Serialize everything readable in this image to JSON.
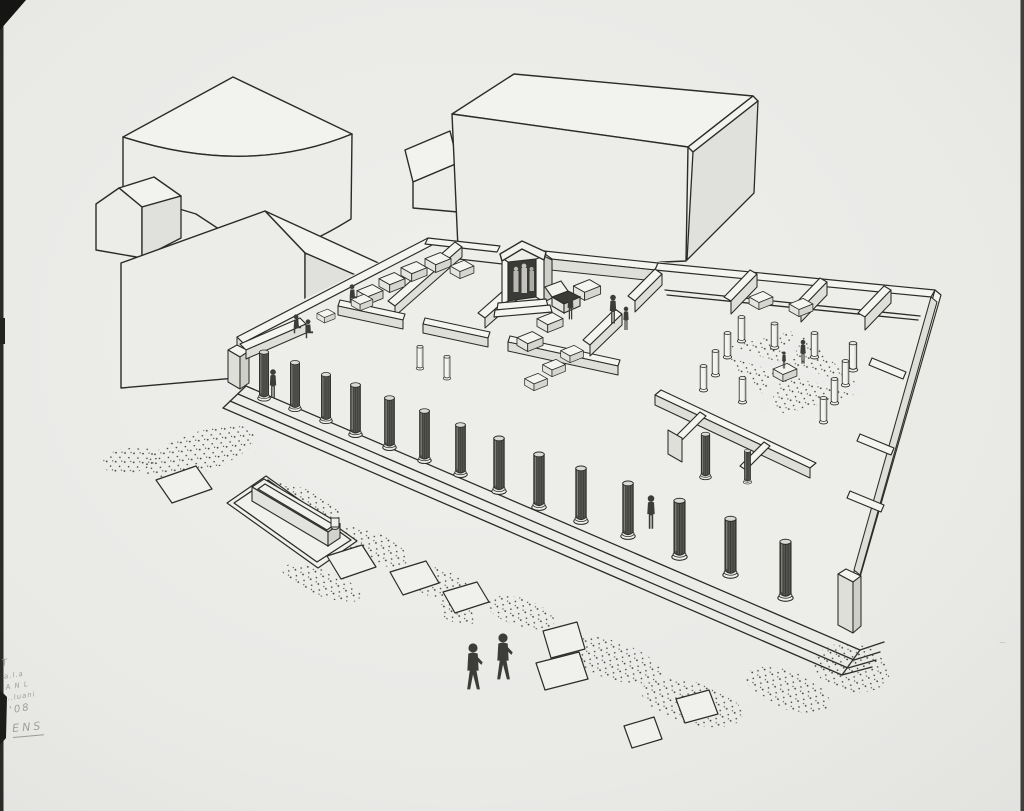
{
  "page": {
    "kind": "scanned-slide-of-pen-and-ink-isometric-reconstruction-drawing",
    "orientation": "landscape"
  },
  "drawing": {
    "subject": "isometric reconstruction of an excavated classical forum / market complex with surrounding town buildings",
    "elements": {
      "background_buildings": [
        "curved-roof-building",
        "gabled-hut",
        "gabled-house",
        "warehouse-building"
      ],
      "front_colonnade_column_count": 14,
      "courtyard_column_stump_count": 11,
      "inner_column_stump_count": 4,
      "paving_slab_count": 8,
      "human_figure_count": 13,
      "features": [
        "aedicula-shrine-with-cult-statues",
        "shop-rooms-with-counters-and-benches",
        "market-tables-and-open-chest",
        "peristyle-courtyard-with-central-altar-and-stippled-floor",
        "stepped-stylobate-with-truncated-columns",
        "statue-base-platform-with-trough",
        "scattered-paving-slabs",
        "rubble-stipple-fields"
      ]
    }
  },
  "colors": {
    "paper": "#e9e9e6",
    "ink": "#2b2b27",
    "wall_top": "#f4f4f1",
    "wall_shade": "#dfdfda",
    "column_dark": "#555551",
    "shrine_interior": "#3a3a36",
    "stipple": "#3a3a36",
    "film_edge": "#2a2a28"
  },
  "marginalia": {
    "lines": [
      "T",
      "a.l.a",
      "A N L",
      "..luani",
      "'08",
      "ENS"
    ],
    "right_edge_mark": "~"
  }
}
